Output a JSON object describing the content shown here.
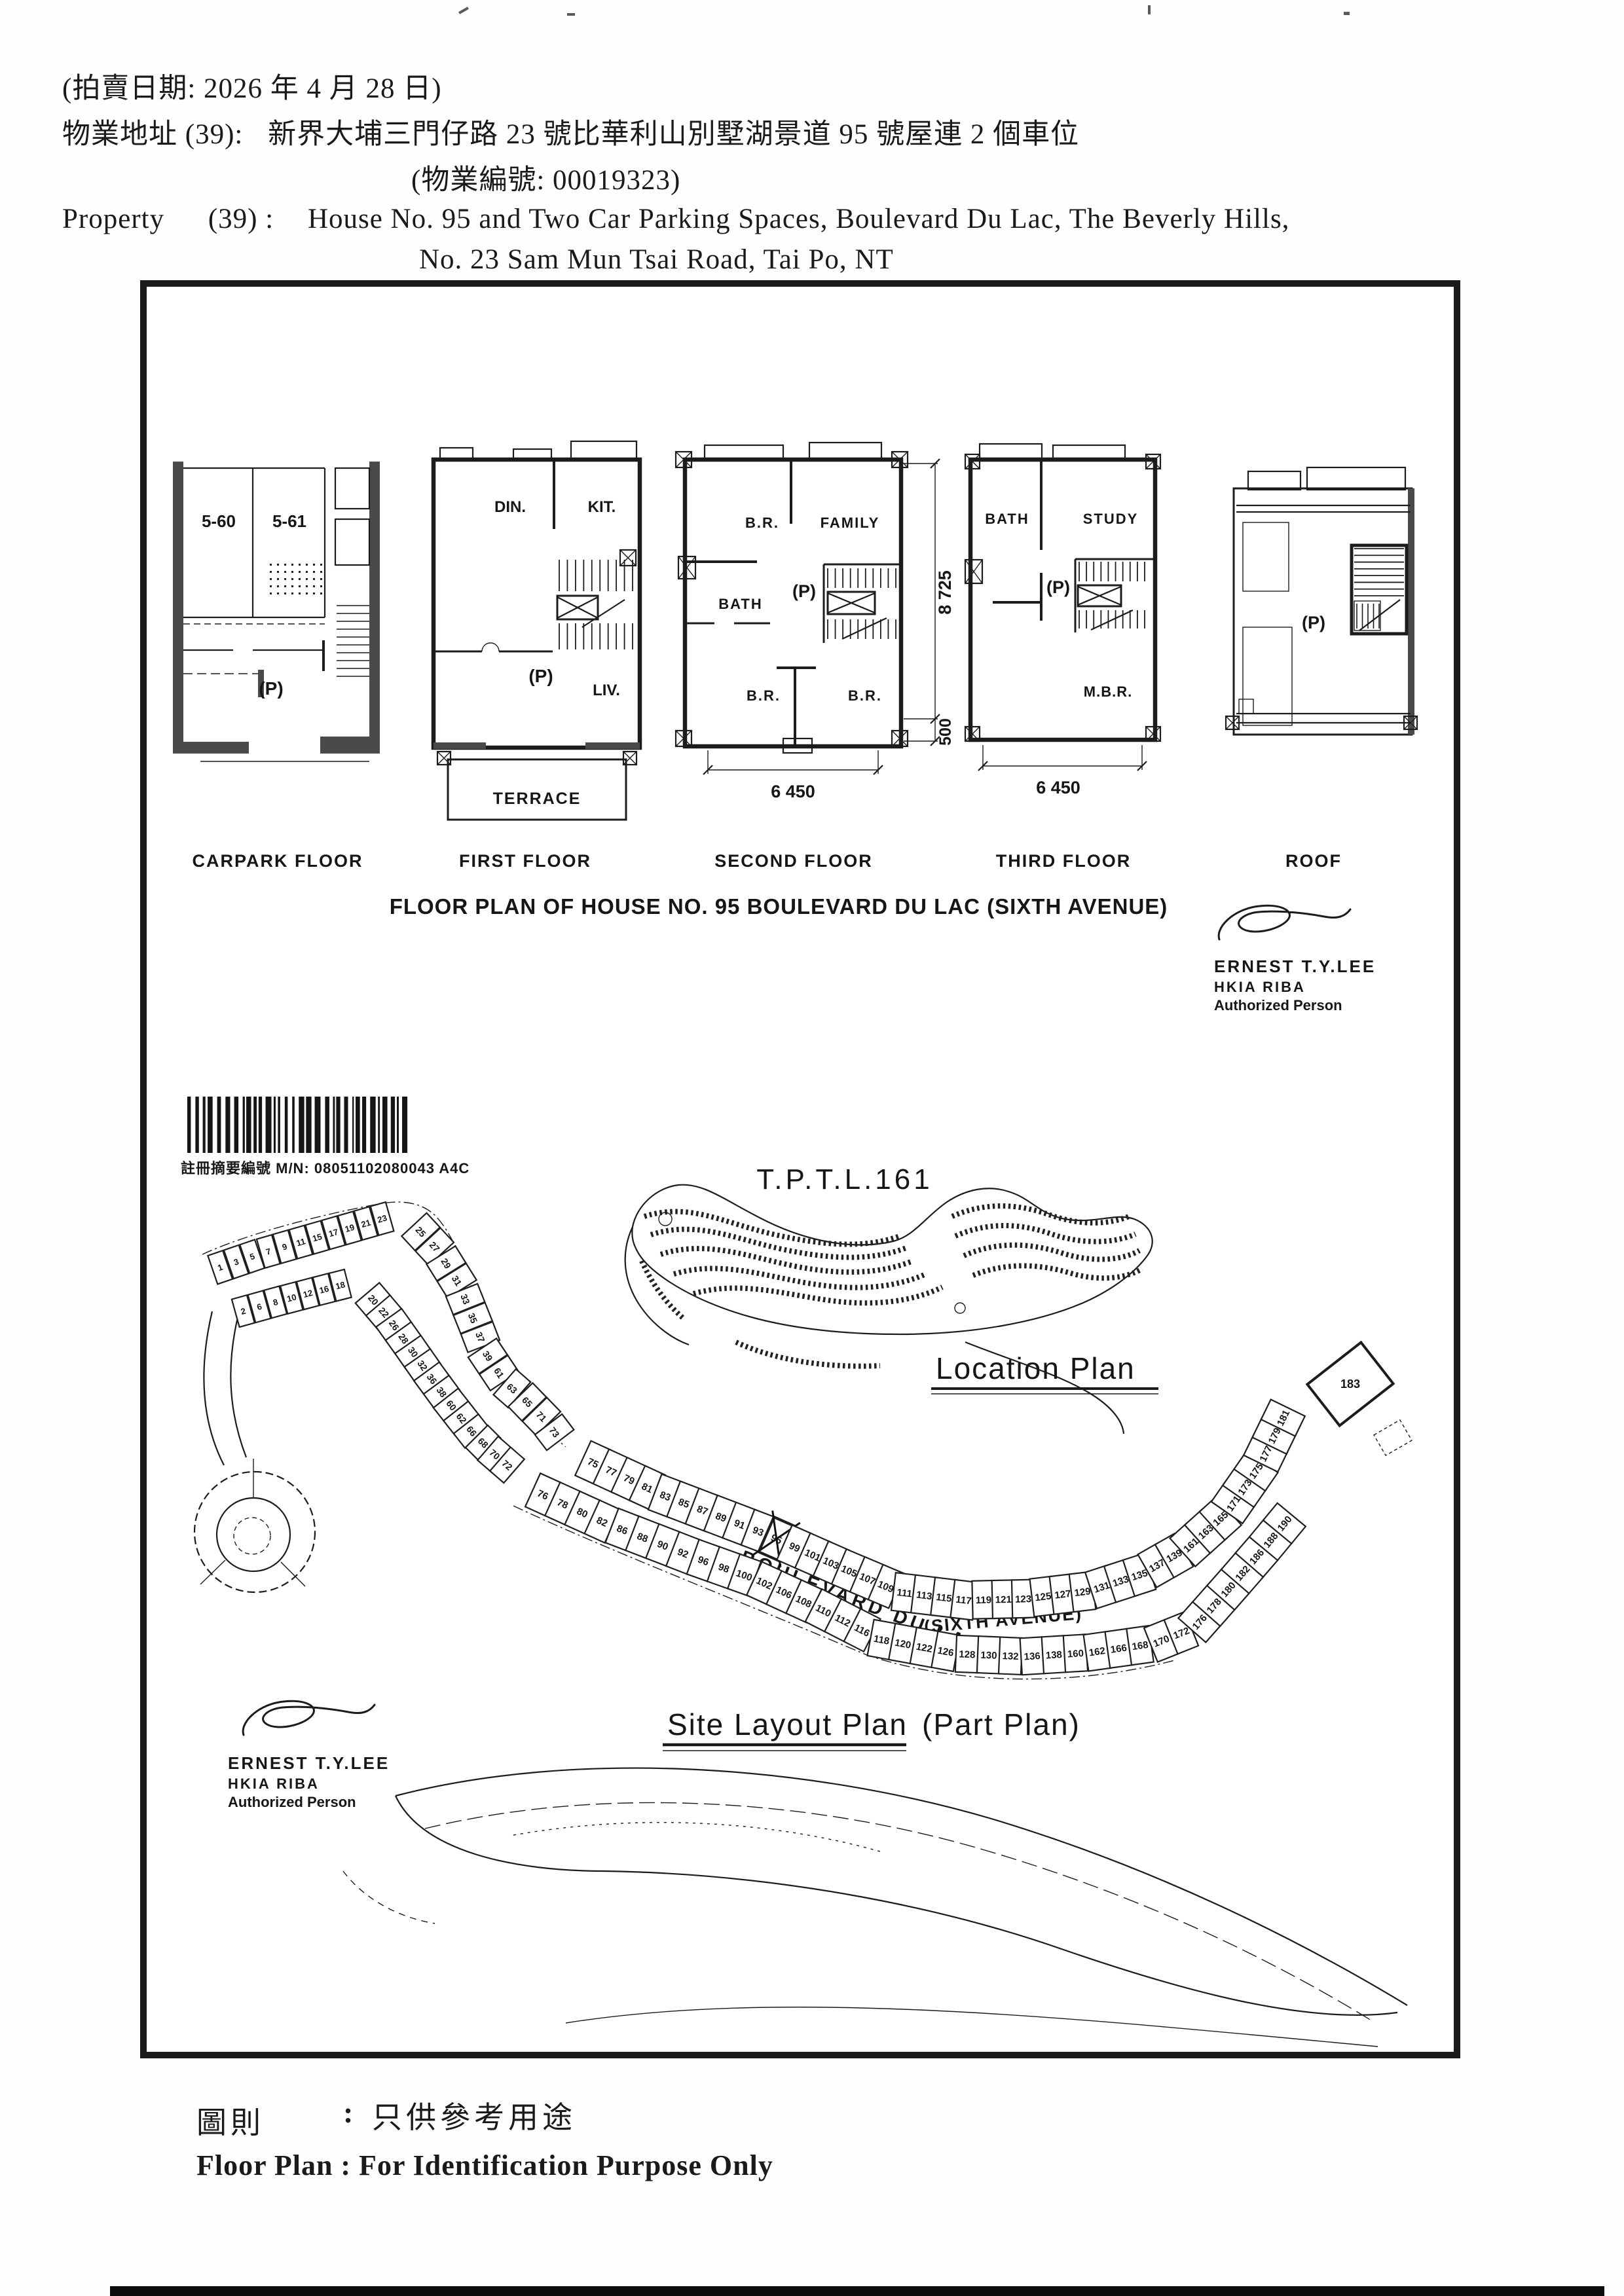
{
  "header": {
    "line1": "(拍賣日期:  2026 年 4 月 28 日)",
    "line2_label": "物業地址 (39):",
    "line2_value": "新界大埔三門仔路 23 號比華利山別墅湖景道 95 號屋連 2 個車位",
    "line3": "(物業編號: 00019323)",
    "line4_label": "Property",
    "line4_num": "(39) :",
    "line4_value": "House No. 95 and Two Car Parking Spaces, Boulevard Du Lac, The Beverly Hills,",
    "line5": "No. 23 Sam Mun Tsai Road, Tai Po, NT"
  },
  "floors": {
    "carpark": {
      "label": "CARPARK FLOOR",
      "stall1": "5-60",
      "stall2": "5-61",
      "p": "(P)"
    },
    "first": {
      "label": "FIRST FLOOR",
      "din": "DIN.",
      "kit": "KIT.",
      "p": "(P)",
      "liv": "LIV.",
      "terrace": "TERRACE"
    },
    "second": {
      "label": "SECOND FLOOR",
      "br1": "B.R.",
      "family": "FAMILY",
      "bath": "BATH",
      "p": "(P)",
      "br2": "B.R.",
      "br3": "B.R.",
      "dim_h": "8 725",
      "dim_500": "500",
      "dim_w": "6 450"
    },
    "third": {
      "label": "THIRD FLOOR",
      "bath": "BATH",
      "study": "STUDY",
      "p": "(P)",
      "mbr": "M.B.R.",
      "dim_w": "6 450"
    },
    "roof": {
      "label": "ROOF",
      "p": "(P)"
    }
  },
  "title": "FLOOR PLAN OF HOUSE NO. 95 BOULEVARD DU LAC (SIXTH AVENUE)",
  "architect": {
    "name": "ERNEST T.Y.LEE",
    "quals": "HKIA   RIBA",
    "role": "Authorized Person"
  },
  "barcode_label": "註冊摘要編號 M/N: 08051102080043    A4C",
  "location_plan": {
    "lot_title": "T.P.T.L.161",
    "caption": "Location Plan"
  },
  "site_plan": {
    "caption": "Site Layout Plan",
    "caption_suffix": "(Part Plan)",
    "road1": "BOULEVARD DU LAC",
    "road2": "(SIXTH AVENUE)",
    "subject_lot": "95",
    "rows": {
      "a_upper": [
        "1",
        "3",
        "5",
        "7",
        "9",
        "11",
        "15",
        "17",
        "19",
        "21",
        "23"
      ],
      "a_lower": [
        "2",
        "6",
        "8",
        "10",
        "12",
        "16",
        "18"
      ],
      "b_outer": [
        "25",
        "27",
        "29",
        "31",
        "33",
        "35",
        "37",
        "39",
        "61",
        "63",
        "65",
        "71",
        "73"
      ],
      "b_inner": [
        "20",
        "22",
        "26",
        "28",
        "30",
        "32",
        "36",
        "38",
        "60",
        "62",
        "66",
        "68",
        "70",
        "72"
      ],
      "c_upper": [
        "75",
        "77",
        "79",
        "81",
        "83",
        "85",
        "87",
        "89",
        "91",
        "93",
        "95",
        "99",
        "101",
        "103",
        "105",
        "107",
        "109",
        "111",
        "113",
        "115",
        "117",
        "119",
        "121",
        "123",
        "125",
        "127",
        "129",
        "131",
        "133",
        "135",
        "137",
        "139",
        "161",
        "163",
        "165",
        "171",
        "173",
        "175",
        "177",
        "179",
        "181"
      ],
      "c_lower": [
        "76",
        "78",
        "80",
        "82",
        "86",
        "88",
        "90",
        "92",
        "96",
        "98",
        "100",
        "102",
        "106",
        "108",
        "110",
        "112",
        "116",
        "118",
        "120",
        "122",
        "126",
        "128",
        "130",
        "132",
        "136",
        "138",
        "160",
        "162",
        "166",
        "168",
        "170",
        "172",
        "176",
        "178",
        "180",
        "182",
        "186",
        "188",
        "190"
      ],
      "big_lot": "183"
    }
  },
  "footer": {
    "zh_label": "圖則",
    "zh_colon": ":",
    "zh_value": "只供參考用途",
    "en": "Floor Plan : For Identification Purpose Only"
  }
}
